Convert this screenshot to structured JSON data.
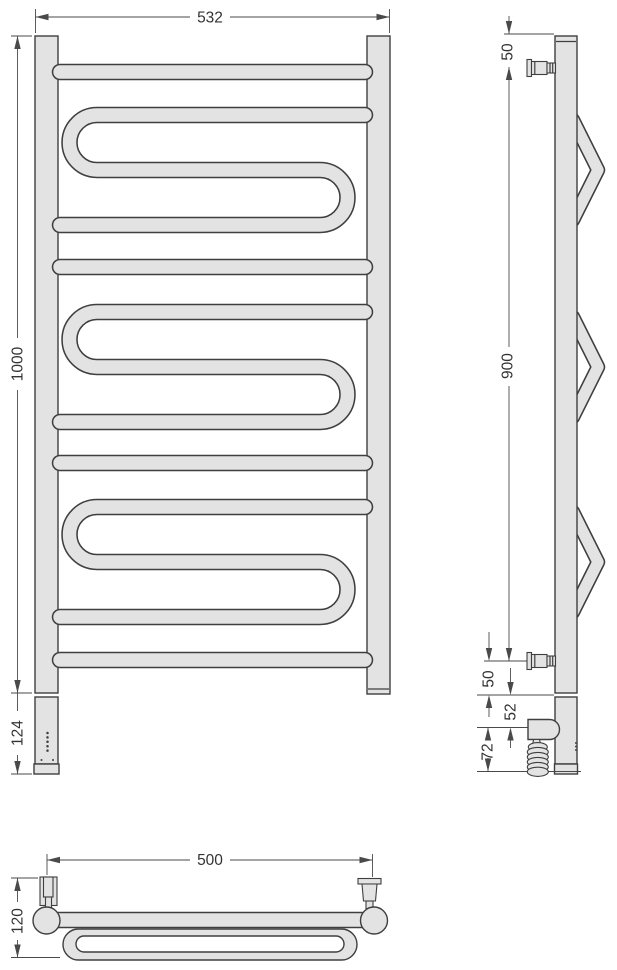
{
  "drawing": {
    "front_view": {
      "width_mm": "532",
      "height_mm": "1000",
      "heating_unit_mm": "124"
    },
    "side_view": {
      "top_bracket_offset_mm": "50",
      "bracket_span_mm": "900",
      "bottom_bracket_offset_mm": "50",
      "power_box_offset_mm": "52",
      "power_box_zone_mm": "72"
    },
    "top_view": {
      "bracket_spacing_mm": "500",
      "depth_mm": "120"
    }
  },
  "colors": {
    "tube_fill": "#e3e3e3",
    "outline": "#3f3f3f",
    "dimension": "#4a4a4a",
    "label": "#333333",
    "background": "#ffffff"
  }
}
